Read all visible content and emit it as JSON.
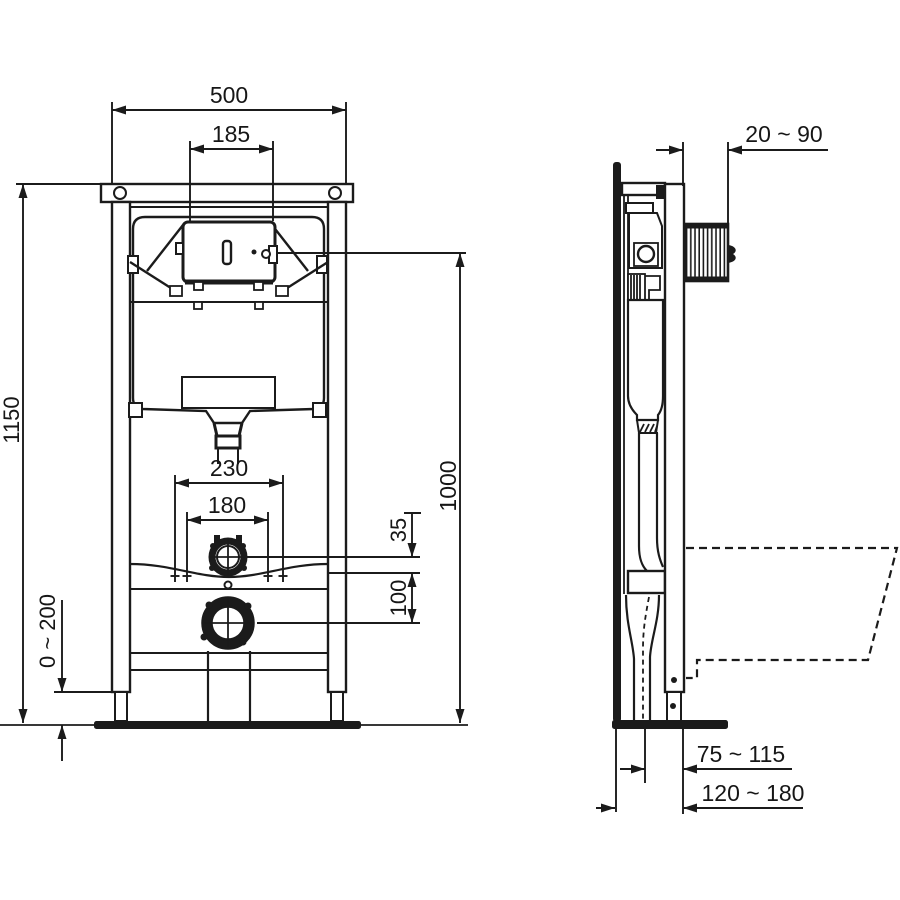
{
  "drawing": {
    "background": "#ffffff",
    "line_color": "#1b1b1b",
    "views": [
      "front view",
      "side view"
    ]
  },
  "front_view": {
    "dims": {
      "overall_width": "500",
      "flush_plate_width": "185",
      "overall_height": "1150",
      "foot_adjustment": "0 ~ 200",
      "fixing_spacing_outer": "230",
      "fixing_spacing_inner": "180",
      "supply_offset": "35",
      "supply_to_outlet": "100",
      "flush_plate_center_height": "1000"
    }
  },
  "side_view": {
    "dims": {
      "front_depth_range": "20 ~ 90",
      "outlet_offset_range": "75 ~ 115",
      "outlet_wall_distance_range": "120 ~ 180"
    }
  }
}
